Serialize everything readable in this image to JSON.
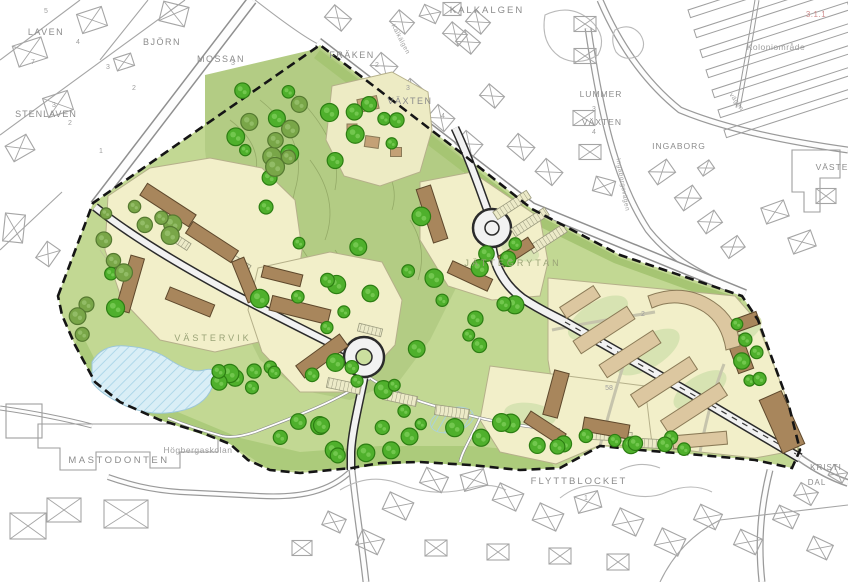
{
  "map": {
    "type": "site-development-plan",
    "district_labels": [
      {
        "name": "kalkalgen",
        "text": "KALKALGEN",
        "x": 487,
        "y": 13,
        "size": 9.5,
        "color": "label_gray",
        "ls": 2
      },
      {
        "name": "laven",
        "text": "LAVEN",
        "x": 46,
        "y": 35,
        "size": 9,
        "color": "label_gray",
        "ls": 1.5
      },
      {
        "name": "bjorn",
        "text": "BJÖRN",
        "x": 162,
        "y": 45,
        "size": 9,
        "color": "label_gray",
        "ls": 1.5
      },
      {
        "name": "mossan",
        "text": "MOSSAN",
        "x": 221,
        "y": 62,
        "size": 9,
        "color": "label_gray",
        "ls": 1.5
      },
      {
        "name": "stenlaven",
        "text": "STENLAVEN",
        "x": 46,
        "y": 117,
        "size": 9,
        "color": "label_gray",
        "ls": 1
      },
      {
        "name": "fraken",
        "text": "FRÄKEN",
        "x": 352,
        "y": 58,
        "size": 9,
        "color": "label_gray",
        "ls": 1.5
      },
      {
        "name": "vaxten-1",
        "text": "VÄXTEN",
        "x": 410,
        "y": 104,
        "size": 9,
        "color": "label_gray",
        "ls": 1.5
      },
      {
        "name": "lummer",
        "text": "LUMMER",
        "x": 601,
        "y": 97,
        "size": 8.5,
        "color": "label_gray",
        "ls": 1
      },
      {
        "name": "vaxten-2",
        "text": "VÄXTEN",
        "x": 602,
        "y": 125,
        "size": 8.5,
        "color": "label_gray",
        "ls": 1
      },
      {
        "name": "ingaborg",
        "text": "INGABORG",
        "x": 679,
        "y": 149,
        "size": 8.5,
        "color": "label_gray",
        "ls": 1
      },
      {
        "name": "koloniomrade",
        "text": "Koloniområde",
        "x": 776,
        "y": 50,
        "size": 8.5,
        "color": "label_light",
        "ls": 0.5
      },
      {
        "name": "ref-311",
        "text": "3.1.1",
        "x": 816,
        "y": 17,
        "size": 8,
        "color": "label_pink",
        "ls": 0.5
      },
      {
        "name": "vaste",
        "text": "VÄSTE",
        "x": 832,
        "y": 170,
        "size": 8.5,
        "color": "label_gray",
        "ls": 1
      },
      {
        "name": "jattegrytan",
        "text": "JÄTTEGRYTAN",
        "x": 513,
        "y": 266,
        "size": 9,
        "color": "label_faint",
        "ls": 3
      },
      {
        "name": "vastervik",
        "text": "VÄSTERVIK",
        "x": 213,
        "y": 341,
        "size": 9,
        "color": "label_faint",
        "ls": 3
      },
      {
        "name": "hogbergaskolan",
        "text": "Högbergaskolan",
        "x": 198,
        "y": 453,
        "size": 8.5,
        "color": "label_light",
        "ls": 0.5
      },
      {
        "name": "mastodonten",
        "text": "MASTODONTEN",
        "x": 119,
        "y": 463,
        "size": 9.5,
        "color": "label_gray",
        "ls": 2.5
      },
      {
        "name": "flyttblocket",
        "text": "FLYTTBLOCKET",
        "x": 579,
        "y": 484,
        "size": 9.5,
        "color": "label_gray",
        "ls": 2
      },
      {
        "name": "kristi",
        "text": "KRISTI",
        "x": 826,
        "y": 470,
        "size": 8,
        "color": "label_gray",
        "ls": 1
      },
      {
        "name": "dal",
        "text": "DAL",
        "x": 817,
        "y": 485,
        "size": 8,
        "color": "label_gray",
        "ls": 1
      }
    ],
    "street_labels": [
      {
        "name": "street-kalkalgen",
        "text": "Kalkälgen",
        "x": 399,
        "y": 40,
        "size": 6.5,
        "color": "label_light",
        "rot": 62
      },
      {
        "name": "street-ingaborgsvagen",
        "text": "Ingaborgsvägen",
        "x": 621,
        "y": 185,
        "size": 6.5,
        "color": "label_light",
        "rot": 80
      },
      {
        "name": "street-vagen",
        "text": "vägen",
        "x": 735,
        "y": 103,
        "size": 6.5,
        "color": "label_light",
        "rot": 55
      }
    ],
    "parcel_numbers": [
      {
        "text": "5",
        "x": 46,
        "y": 13
      },
      {
        "text": "4",
        "x": 78,
        "y": 44
      },
      {
        "text": "3",
        "x": 108,
        "y": 69
      },
      {
        "text": "2",
        "x": 134,
        "y": 90
      },
      {
        "text": "7",
        "x": 33,
        "y": 64
      },
      {
        "text": "3",
        "x": 233,
        "y": 65
      },
      {
        "text": "3",
        "x": 54,
        "y": 107
      },
      {
        "text": "2",
        "x": 70,
        "y": 125
      },
      {
        "text": "1",
        "x": 101,
        "y": 153
      },
      {
        "text": "2",
        "x": 377,
        "y": 67
      },
      {
        "text": "3",
        "x": 408,
        "y": 90
      },
      {
        "text": "4",
        "x": 443,
        "y": 118
      },
      {
        "text": "3",
        "x": 594,
        "y": 111
      },
      {
        "text": "4",
        "x": 594,
        "y": 134
      },
      {
        "text": "1",
        "x": 586,
        "y": 500
      },
      {
        "text": "58",
        "x": 609,
        "y": 390
      },
      {
        "text": "2",
        "x": 643,
        "y": 316
      }
    ],
    "colors": {
      "plan_green": "#c2d893",
      "nature_green": "#b3cc84",
      "verge_green": "#a6c573",
      "south_green": "#accb7b",
      "pad_yellow": "#f2efc9",
      "pad_pale": "#edebc4",
      "pad_outline": "#b5b08a",
      "courtyard_green": "#d7e3b2",
      "building_brown": "#a8865c",
      "building_outline": "#5e482c",
      "existing_tan": "#dcc7a0",
      "tan_outline": "#8a7a57",
      "cottage_tan": "#c4a176",
      "tree_green": "#4fb02c",
      "tree_outline": "#2c7e12",
      "tree_inner": "#72c74e",
      "tree_olive": "#79a648",
      "tree_olive_outline": "#557930",
      "tree_olive_inner": "#92bc66",
      "pond_blue": "#d9eef6",
      "pond_outline": "#9cc6d8",
      "pond_hatch": "#a5d2e6",
      "road_fill": "#f2f2f2",
      "road_casing": "#2b2b2b",
      "outer_road_casing": "#9a9a9a",
      "fabric_gray": "#a5a5a5",
      "boundary_black": "#151515",
      "label_gray": "#8c8c8c",
      "label_light": "#9e9e9e",
      "label_faint": "#9aa377",
      "label_pink": "#cf9090"
    }
  }
}
